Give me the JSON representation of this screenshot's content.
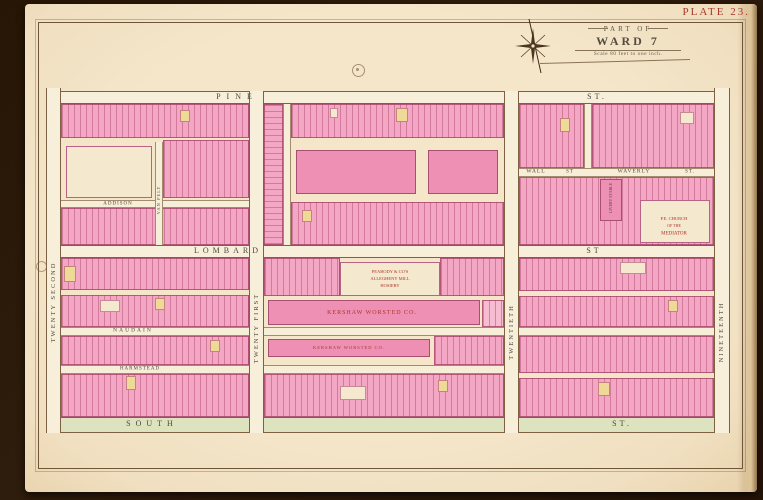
{
  "plate": {
    "label": "PLATE 23."
  },
  "title": {
    "part_of": "PART OF",
    "ward": "WARD 7",
    "scale": "Scale 80 feet to one inch."
  },
  "palette": {
    "ink": "#46443a",
    "faded": "#4c493d",
    "red": "#ae3527",
    "paper": "#f3e4c8",
    "street": "#f8efda",
    "south_street": "#dde2bf",
    "lot_pink": "#f3a7c4",
    "lot_yellow": "#eeda96",
    "neatline": "#6f5638"
  },
  "map": {
    "streets": [
      {
        "id": "pine",
        "dir": "h",
        "kind": "major",
        "x": 46,
        "y": 91,
        "w": 684,
        "h": 13
      },
      {
        "id": "lombard",
        "dir": "h",
        "kind": "major",
        "x": 46,
        "y": 245,
        "w": 684,
        "h": 13
      },
      {
        "id": "south",
        "dir": "h",
        "kind": "south",
        "x": 46,
        "y": 417,
        "w": 684,
        "h": 16
      },
      {
        "id": "naudain",
        "dir": "h",
        "kind": "minor",
        "x": 61,
        "y": 327,
        "w": 653,
        "h": 9
      },
      {
        "id": "harmstead",
        "dir": "h",
        "kind": "minor",
        "x": 61,
        "y": 365,
        "w": 458,
        "h": 9
      },
      {
        "id": "wall-waverly",
        "dir": "h",
        "kind": "minor",
        "x": 519,
        "y": 168,
        "w": 195,
        "h": 9
      },
      {
        "id": "addison",
        "dir": "h",
        "kind": "minor",
        "x": 61,
        "y": 200,
        "w": 188,
        "h": 8
      },
      {
        "id": "twenty-second",
        "dir": "v",
        "kind": "major",
        "x": 46,
        "y": 88,
        "w": 15,
        "h": 345
      },
      {
        "id": "twenty-first",
        "dir": "v",
        "kind": "major",
        "x": 249,
        "y": 91,
        "w": 15,
        "h": 342
      },
      {
        "id": "twentieth",
        "dir": "v",
        "kind": "major",
        "x": 504,
        "y": 91,
        "w": 15,
        "h": 342
      },
      {
        "id": "nineteenth",
        "dir": "v",
        "kind": "major",
        "x": 714,
        "y": 88,
        "w": 16,
        "h": 345
      },
      {
        "id": "van-pelt",
        "dir": "v",
        "kind": "minor",
        "x": 155,
        "y": 142,
        "w": 8,
        "h": 103
      },
      {
        "id": "central-lane",
        "dir": "v",
        "kind": "minor",
        "x": 283,
        "y": 104,
        "w": 8,
        "h": 141
      },
      {
        "id": "upper-right-lane",
        "dir": "v",
        "kind": "minor",
        "x": 584,
        "y": 104,
        "w": 8,
        "h": 64
      }
    ],
    "strips": [
      {
        "x": 61,
        "y": 104,
        "w": 188,
        "h": 34
      },
      {
        "x": 163,
        "y": 140,
        "w": 86,
        "h": 58
      },
      {
        "x": 61,
        "y": 208,
        "w": 188,
        "h": 37
      },
      {
        "x": 264,
        "y": 104,
        "w": 19,
        "h": 141,
        "lines": "h"
      },
      {
        "x": 291,
        "y": 104,
        "w": 213,
        "h": 34
      },
      {
        "x": 291,
        "y": 202,
        "w": 213,
        "h": 43
      },
      {
        "x": 519,
        "y": 104,
        "w": 65,
        "h": 64
      },
      {
        "x": 592,
        "y": 104,
        "w": 122,
        "h": 64
      },
      {
        "x": 519,
        "y": 177,
        "w": 195,
        "h": 68
      },
      {
        "x": 61,
        "y": 258,
        "w": 188,
        "h": 32
      },
      {
        "x": 61,
        "y": 295,
        "w": 188,
        "h": 32
      },
      {
        "x": 264,
        "y": 258,
        "w": 76,
        "h": 38
      },
      {
        "x": 440,
        "y": 258,
        "w": 64,
        "h": 38
      },
      {
        "x": 482,
        "y": 300,
        "w": 22,
        "h": 27,
        "tone": "p2"
      },
      {
        "x": 519,
        "y": 258,
        "w": 195,
        "h": 33
      },
      {
        "x": 519,
        "y": 296,
        "w": 195,
        "h": 31
      },
      {
        "x": 61,
        "y": 336,
        "w": 188,
        "h": 29
      },
      {
        "x": 434,
        "y": 336,
        "w": 70,
        "h": 29
      },
      {
        "x": 519,
        "y": 336,
        "w": 195,
        "h": 37
      },
      {
        "x": 519,
        "y": 378,
        "w": 195,
        "h": 39
      },
      {
        "x": 61,
        "y": 374,
        "w": 188,
        "h": 43
      },
      {
        "x": 264,
        "y": 374,
        "w": 240,
        "h": 43
      }
    ],
    "buildings": [
      {
        "name": "institution-building",
        "x": 66,
        "y": 146,
        "w": 86,
        "h": 52,
        "fill": "cream"
      },
      {
        "name": "mill-building",
        "x": 296,
        "y": 150,
        "w": 120,
        "h": 44,
        "fill": "pink"
      },
      {
        "name": "mill-building",
        "x": 428,
        "y": 150,
        "w": 70,
        "h": 44,
        "fill": "pink"
      },
      {
        "name": "hosiery-mill-building",
        "x": 340,
        "y": 262,
        "w": 100,
        "h": 34,
        "fill": "cream"
      },
      {
        "name": "kershaw-worsted-main-building",
        "x": 268,
        "y": 300,
        "w": 212,
        "h": 25,
        "fill": "pink"
      },
      {
        "name": "kershaw-worsted-long-building",
        "x": 268,
        "y": 339,
        "w": 162,
        "h": 18,
        "fill": "pink"
      },
      {
        "name": "church-of-the-mediator-building",
        "x": 640,
        "y": 200,
        "w": 70,
        "h": 43,
        "fill": "cream"
      },
      {
        "name": "livery-stable-building",
        "x": 600,
        "y": 179,
        "w": 22,
        "h": 42,
        "fill": "pink"
      }
    ],
    "patches": [
      {
        "x": 64,
        "y": 266,
        "w": 12,
        "h": 16,
        "fill": "yellow"
      },
      {
        "x": 126,
        "y": 376,
        "w": 10,
        "h": 14,
        "fill": "yellow"
      },
      {
        "x": 210,
        "y": 340,
        "w": 10,
        "h": 12,
        "fill": "yellow"
      },
      {
        "x": 396,
        "y": 108,
        "w": 12,
        "h": 14,
        "fill": "yellow"
      },
      {
        "x": 302,
        "y": 210,
        "w": 10,
        "h": 12,
        "fill": "yellow"
      },
      {
        "x": 560,
        "y": 118,
        "w": 10,
        "h": 14,
        "fill": "yellow"
      },
      {
        "x": 668,
        "y": 300,
        "w": 10,
        "h": 12,
        "fill": "yellow"
      },
      {
        "x": 155,
        "y": 298,
        "w": 10,
        "h": 12,
        "fill": "yellow"
      },
      {
        "x": 438,
        "y": 380,
        "w": 10,
        "h": 12,
        "fill": "yellow"
      },
      {
        "x": 598,
        "y": 382,
        "w": 12,
        "h": 14,
        "fill": "yellow"
      },
      {
        "x": 180,
        "y": 110,
        "w": 10,
        "h": 12,
        "fill": "yellow"
      },
      {
        "x": 330,
        "y": 108,
        "w": 8,
        "h": 10,
        "fill": "cream"
      },
      {
        "x": 620,
        "y": 262,
        "w": 26,
        "h": 12,
        "fill": "cream"
      },
      {
        "x": 100,
        "y": 300,
        "w": 20,
        "h": 12,
        "fill": "cream"
      },
      {
        "x": 340,
        "y": 386,
        "w": 26,
        "h": 14,
        "fill": "cream"
      },
      {
        "x": 680,
        "y": 112,
        "w": 14,
        "h": 12,
        "fill": "cream"
      }
    ],
    "labels": [
      {
        "n": "street-label-pine",
        "t": "PINE",
        "x": 237,
        "y": 97,
        "s": 8,
        "ls": 6,
        "c": "faded"
      },
      {
        "n": "street-label-pine-st",
        "t": "ST.",
        "x": 597,
        "y": 97,
        "s": 8,
        "ls": 3,
        "c": "faded"
      },
      {
        "n": "street-label-lombard",
        "t": "LOMBARD",
        "x": 228,
        "y": 251,
        "s": 8,
        "ls": 4,
        "c": "faded"
      },
      {
        "n": "street-label-lombard-st",
        "t": "ST",
        "x": 594,
        "y": 251,
        "s": 8,
        "ls": 3,
        "c": "faded"
      },
      {
        "n": "street-label-south",
        "t": "SOUTH",
        "x": 152,
        "y": 424,
        "s": 8,
        "ls": 5,
        "c": "faded"
      },
      {
        "n": "street-label-south-st",
        "t": "ST.",
        "x": 622,
        "y": 424,
        "s": 8,
        "ls": 3,
        "c": "faded"
      },
      {
        "n": "street-label-naudain",
        "t": "NAUDAIN",
        "x": 133,
        "y": 331,
        "s": 5.5,
        "ls": 2,
        "c": "faded"
      },
      {
        "n": "street-label-harmstead",
        "t": "HARMSTEAD",
        "x": 140,
        "y": 369,
        "s": 5,
        "ls": 1,
        "c": "faded"
      },
      {
        "n": "street-label-addison",
        "t": "ADDISON",
        "x": 118,
        "y": 204,
        "s": 5,
        "ls": 1,
        "c": "faded"
      },
      {
        "n": "street-label-wall",
        "t": "WALL",
        "x": 536,
        "y": 172,
        "s": 5.5,
        "ls": 1,
        "c": "faded"
      },
      {
        "n": "street-label-wall-st",
        "t": "ST",
        "x": 570,
        "y": 172,
        "s": 5,
        "ls": 1,
        "c": "faded"
      },
      {
        "n": "street-label-waverly",
        "t": "WAVERLY",
        "x": 634,
        "y": 172,
        "s": 5.5,
        "ls": 1,
        "c": "faded"
      },
      {
        "n": "street-label-waverly-st",
        "t": "ST.",
        "x": 690,
        "y": 172,
        "s": 5,
        "ls": 1,
        "c": "faded"
      },
      {
        "n": "street-label-twenty-second",
        "t": "TWENTY SECOND",
        "x": 54,
        "y": 302,
        "s": 6.5,
        "ls": 2,
        "r": -90,
        "c": "faded"
      },
      {
        "n": "street-label-twenty-first",
        "t": "TWENTY FIRST",
        "x": 257,
        "y": 328,
        "s": 6.5,
        "ls": 2,
        "r": -90,
        "c": "faded"
      },
      {
        "n": "street-label-twentieth",
        "t": "TWENTIETH",
        "x": 512,
        "y": 332,
        "s": 6.5,
        "ls": 2,
        "r": -90,
        "c": "faded"
      },
      {
        "n": "street-label-nineteenth",
        "t": "NINETEENTH",
        "x": 722,
        "y": 332,
        "s": 6.5,
        "ls": 2,
        "r": -90,
        "c": "faded"
      },
      {
        "n": "street-label-van-pelt",
        "t": "VAN PELT",
        "x": 159,
        "y": 200,
        "s": 4.5,
        "ls": 1,
        "r": -90,
        "c": "faded"
      },
      {
        "n": "building-label-hosiery-1",
        "t": "PEABODY & CO'S",
        "x": 390,
        "y": 272,
        "s": 4.5,
        "ls": 0,
        "c": "red"
      },
      {
        "n": "building-label-hosiery-2",
        "t": "ALLEGHENY MILL",
        "x": 390,
        "y": 279,
        "s": 4.5,
        "ls": 0,
        "c": "red"
      },
      {
        "n": "building-label-hosiery-3",
        "t": "HOSIERY",
        "x": 390,
        "y": 286,
        "s": 4.5,
        "ls": 0,
        "c": "red"
      },
      {
        "n": "building-label-kershaw-main",
        "t": "KERSHAW WORSTED CO.",
        "x": 372,
        "y": 313,
        "s": 6,
        "ls": 1,
        "c": "red"
      },
      {
        "n": "building-label-kershaw-long",
        "t": "KERSHAW WORSTED CO.",
        "x": 349,
        "y": 348,
        "s": 4.5,
        "ls": 1,
        "c": "red"
      },
      {
        "n": "building-label-church-1",
        "t": "P.E. CHURCH",
        "x": 674,
        "y": 219,
        "s": 4.5,
        "ls": 0,
        "c": "red"
      },
      {
        "n": "building-label-church-2",
        "t": "OF THE",
        "x": 674,
        "y": 226,
        "s": 4,
        "ls": 0,
        "c": "red"
      },
      {
        "n": "building-label-church-3",
        "t": "MEDIATOR",
        "x": 674,
        "y": 234,
        "s": 5,
        "ls": 0,
        "c": "red"
      },
      {
        "n": "building-label-livery-stable",
        "t": "LIVERY STABLE",
        "x": 611,
        "y": 198,
        "s": 4,
        "ls": 0,
        "r": -90,
        "c": "faded"
      }
    ]
  }
}
